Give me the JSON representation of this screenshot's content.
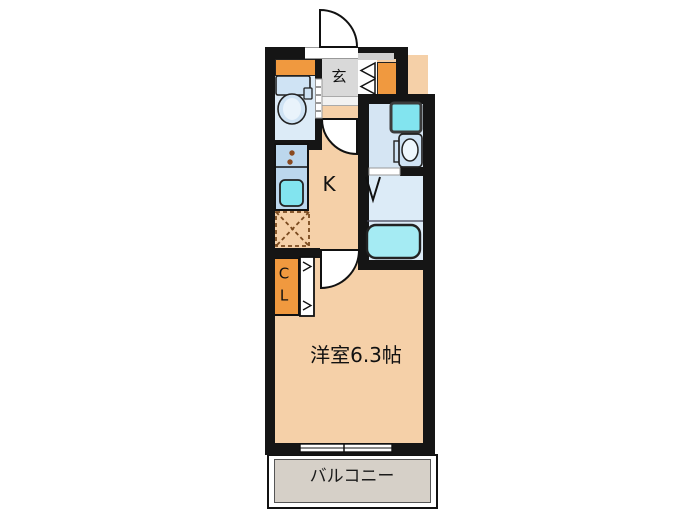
{
  "floorplan": {
    "entrance_label": "玄",
    "kitchen_label": "K",
    "closet_letters": {
      "c": "C",
      "l": "L"
    },
    "main_room_label": "洋室6.3帖",
    "balcony_label": "バルコニー",
    "colors": {
      "wall": "#151515",
      "room_peach": "#f5d0a8",
      "accent_orange": "#f0993f",
      "entry_gray": "#d9d9d9",
      "balcony_gray": "#d6d0c8",
      "wet_blue": "#dcebf7",
      "wash_blue": "#d5e5f3",
      "counter_blue": "#bcd7ed",
      "fixture_cyan": "#82e4ef",
      "tub_cyan": "#a5ebf3",
      "fixture_blue": "#cfe3f4"
    }
  }
}
